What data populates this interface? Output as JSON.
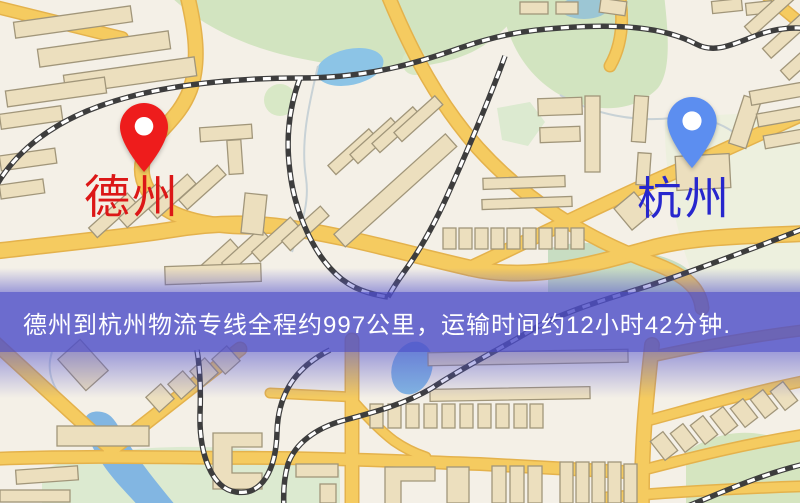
{
  "map": {
    "origin": {
      "name": "德州"
    },
    "destination": {
      "name": "杭州"
    },
    "banner": {
      "text": "德州到杭州物流专线全程约997公里，运输时间约12小时42分钟."
    },
    "route": {
      "distance_text": "约997公里",
      "duration_text": "约12小时42分钟"
    }
  },
  "theme": {
    "map_bg": "#f4f0e7",
    "road_fill": "#f5cb60",
    "road_casing": "#e4b24c",
    "building_fill": "#ecdfbe",
    "building_stroke": "#a1967a",
    "park_green": "#d2e4c0",
    "water_blue": "#8cc4e6",
    "rail_dark": "#3d3d3d",
    "banner_overlay": "#4e4ec8",
    "banner_text": "#ffffff",
    "origin_pin": "#ee1c1c",
    "origin_label": "#dc1717",
    "destination_pin": "#5c8ef0",
    "destination_label": "#2727cd"
  }
}
